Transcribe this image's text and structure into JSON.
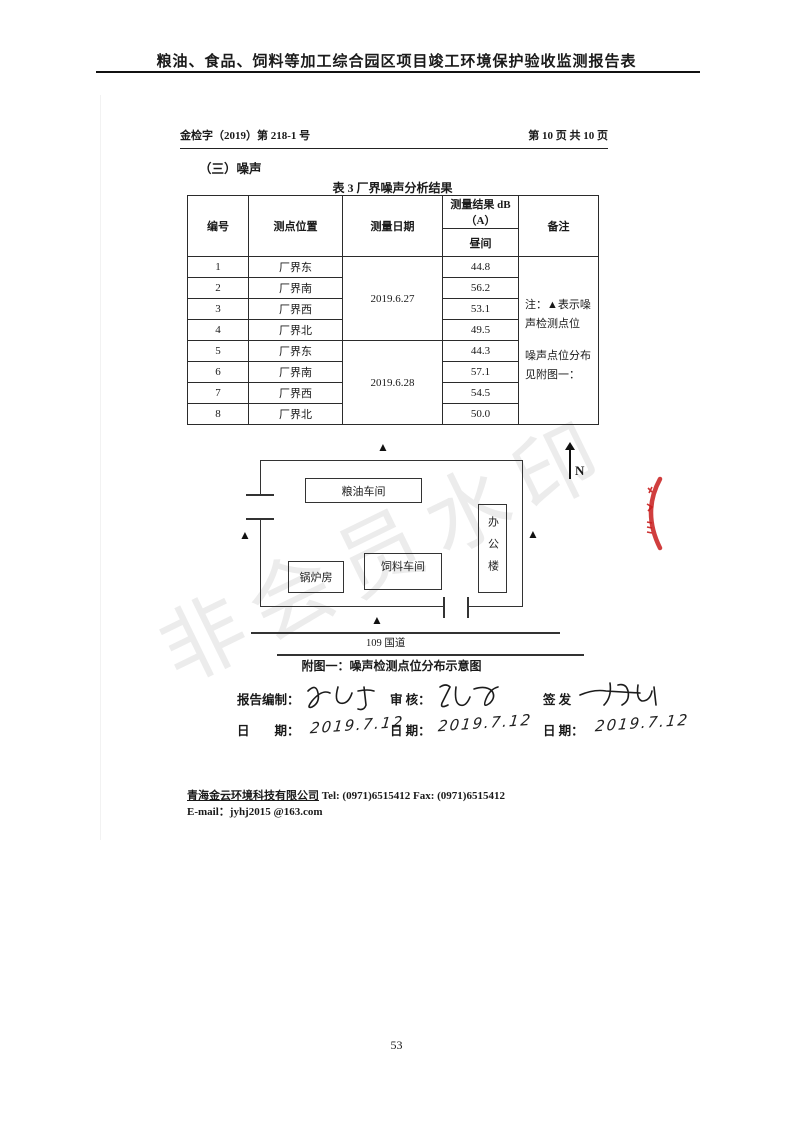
{
  "page": {
    "top_title": "粮油、食品、饲料等加工综合园区项目竣工环境保护验收监测报告表",
    "doc_number": "金检字（2019）第 218-1 号",
    "page_indicator": "第 10 页 共 10 页",
    "section_heading": "（三）噪声",
    "page_number": "53"
  },
  "noise_table": {
    "title": "表 3  厂界噪声分析结果",
    "headers": {
      "id": "编号",
      "location": "测点位置",
      "date": "测量日期",
      "result": "测量结果 dB（A）",
      "period": "昼间",
      "remark": "备注"
    },
    "date_group1": "2019.6.27",
    "date_group2": "2019.6.28",
    "remark_line1": "注：▲表示噪声检测点位",
    "remark_line2": "噪声点位分布见附图一：",
    "rows": [
      {
        "id": "1",
        "location": "厂界东",
        "value": "44.8"
      },
      {
        "id": "2",
        "location": "厂界南",
        "value": "56.2"
      },
      {
        "id": "3",
        "location": "厂界西",
        "value": "53.1"
      },
      {
        "id": "4",
        "location": "厂界北",
        "value": "49.5"
      },
      {
        "id": "5",
        "location": "厂界东",
        "value": "44.3"
      },
      {
        "id": "6",
        "location": "厂界南",
        "value": "57.1"
      },
      {
        "id": "7",
        "location": "厂界西",
        "value": "54.5"
      },
      {
        "id": "8",
        "location": "厂界北",
        "value": "50.0"
      }
    ]
  },
  "diagram": {
    "buildings": {
      "grain_oil": "粮油车间",
      "office": "办公楼",
      "boiler": "锅炉房",
      "feed": "饲料车间"
    },
    "road_label": "109 国道",
    "compass_label": "N",
    "marker_glyph": "▲",
    "caption": "附图一：噪声检测点位分布示意图"
  },
  "signoff": {
    "preparer_label": "报告编制：",
    "reviewer_label": "审 核：",
    "issuer_label": "签 发",
    "date_label_wide": "日　　期：",
    "date_label": "日 期：",
    "date1": "2019.7.12",
    "date2": "2019.7.12",
    "date3": "2019.7.12"
  },
  "footer": {
    "company": "青海金云环境科技有限公司",
    "contacts": "Tel:   (0971)6515412    Fax:   (0971)6515412",
    "email_line": "E-mail：jyhj2015 @163.com"
  },
  "watermark": "非会员水印"
}
